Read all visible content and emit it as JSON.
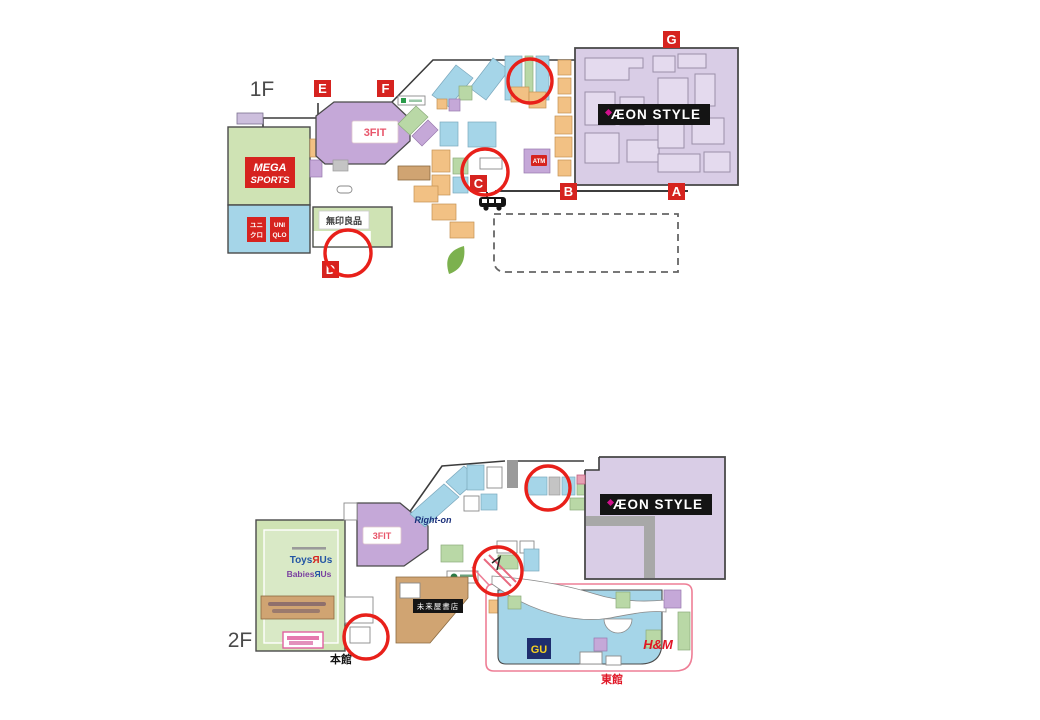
{
  "palette": {
    "marker_red": "#d6231f",
    "circle_red": "#e8201a",
    "aeon_lavender": "#d9cde6",
    "anchor_green": "#cfe3b4",
    "shop_blue": "#a5d5e8",
    "shop_orange": "#f2c184",
    "shop_purple": "#c5a8d8",
    "tan": "#d0a472",
    "east_wing_outline_pink": "#ee7e96",
    "banner_black": "#141414",
    "gu_navy": "#1e2d6e",
    "gu_yellow": "#f5d020",
    "hm_red": "#e01525"
  },
  "floor1": {
    "label": "1F"
  },
  "floor2": {
    "label": "2F"
  },
  "markers": {
    "a": "A",
    "b": "B",
    "c": "C",
    "d": "D",
    "e": "E",
    "f": "F",
    "g": "G"
  },
  "stores": {
    "aeon_style": "ÆON STYLE",
    "mega_sports": {
      "line1": "MEGA",
      "line2": "SPORTS"
    },
    "uniqlo": {
      "jp_line1": "ユニ",
      "jp_line2": "クロ",
      "en_line1": "UNI",
      "en_line2": "QLO"
    },
    "fit": "3FIT",
    "muji": "無印良品",
    "atm": "ATM",
    "right_on": "Right-on",
    "toysrus": {
      "part1": "Toys",
      "part2": "Я",
      "part3": "Us"
    },
    "babiesrus": {
      "part1": "Babies",
      "part2": "Я",
      "part3": "Us"
    },
    "miraiya": "未来屋書店",
    "gu": "GU",
    "hm": "H&M"
  },
  "labels": {
    "honkan": "本館",
    "tokan": "東館"
  }
}
